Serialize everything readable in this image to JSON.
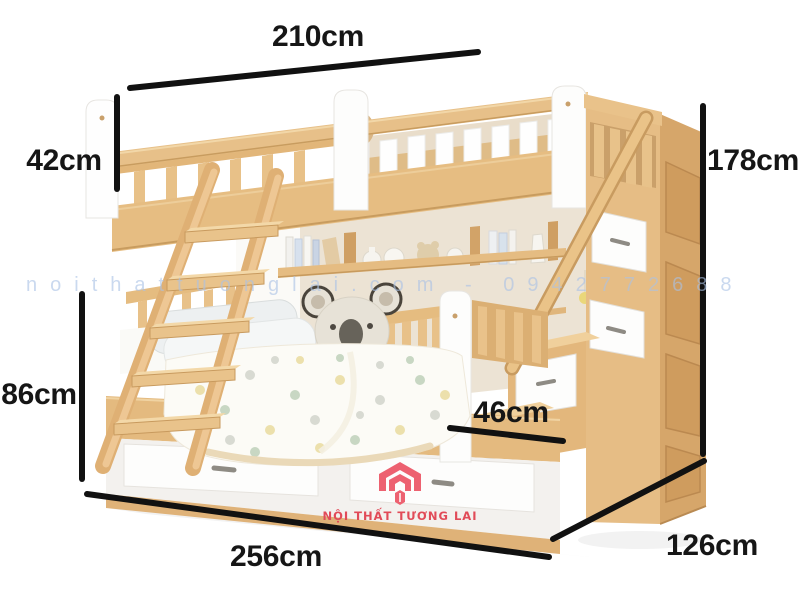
{
  "image": {
    "background": "#ffffff"
  },
  "bed": {
    "badge": "YD"
  },
  "dimensions": {
    "upper_length": "210cm",
    "guard_height": "42cm",
    "overall_height": "178cm",
    "lower_height": "86cm",
    "step_depth": "46cm",
    "overall_length": "256cm",
    "overall_depth": "126cm"
  },
  "watermark": {
    "text": "noithattuonglai.com - 0942772688"
  },
  "brand": {
    "name": "NỘI THẤT TƯƠNG LAI"
  },
  "colors": {
    "dimension_line": "#111111",
    "wood": "#e6bd85",
    "wood_dark": "#cf9f63",
    "wall": "#ece3d4",
    "brand_red": "#ed6170",
    "watermark_blue": "#aac1e5",
    "koala_gray": "#e7e2d7"
  }
}
